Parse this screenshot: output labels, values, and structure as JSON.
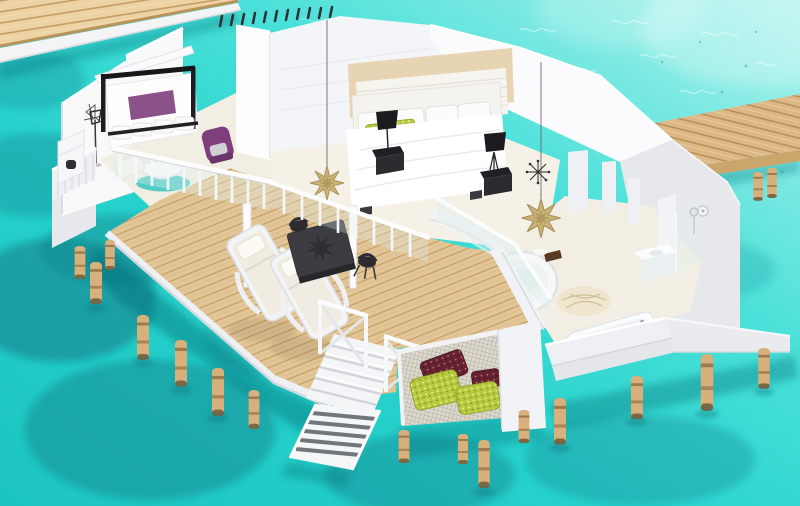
{
  "meta": {
    "title": "Overwater villa 3D cutaway render",
    "scene_type": "isometric architectural visualization",
    "visible_text": "none"
  },
  "colors": {
    "water_light": "#aff3ec",
    "water_bright": "#49e0d9",
    "water_mid": "#27d2cc",
    "water_deep": "#1cc5c0",
    "coral_dark": "#0d7a86",
    "coral_mid": "#129199",
    "wood_light": "#edd2a4",
    "wood_mid": "#ddb887",
    "wood_dark": "#c09a62",
    "wall_white": "#f9f9fa",
    "wall_shade": "#e7e8ec",
    "wall_dark": "#d2d4da",
    "floor_cream": "#f3eee3",
    "cushion_cream": "#f1ece1",
    "accent_purple": "#7e3f7c",
    "rug_teal": "#3ec9c1",
    "pillow_green": "#b9c93f",
    "pillow_maroon": "#66222e",
    "furniture_dark": "#2b2b30",
    "star_gold": "#c8b275",
    "glass_tint": "#dff0ee"
  },
  "scene": {
    "environment": {
      "setting": "turquoise lagoon with coral patches",
      "lighting": "bright daylight with sun glitter on water"
    },
    "structures": [
      {
        "name": "jetty-walkway",
        "material": "wood planks",
        "position": "top-left",
        "detail": "row of small dark bollards"
      },
      {
        "name": "access-boardwalk",
        "material": "wood planks",
        "position": "right edge"
      },
      {
        "name": "villa",
        "style": "white cutaway walls, open roof, on wooden stilts"
      }
    ],
    "rooms": [
      {
        "name": "lounge",
        "furniture": [
          "black-frame-canopy-daybed",
          "purple-armchair",
          "round-coffee-table",
          "teal-rug",
          "white-ottoman",
          "floor-lamp",
          "wall-art-sketch",
          "minibar-shelf",
          "side-balcony"
        ]
      },
      {
        "name": "bedroom",
        "furniture": [
          "double-bed-white",
          "slatted-headboard-panel",
          "beige-feature-wall",
          "black-nightstand-left",
          "black-nightstand-right",
          "black-table-lamp-left",
          "black-table-lamp-right",
          "green-accent-pillows",
          "gold-star-pendant"
        ]
      },
      {
        "name": "bathroom",
        "furniture": [
          "round-soaking-tub",
          "bathtub",
          "vanity",
          "glass-shower",
          "palm-leaf-rug",
          "gold-star-pendant",
          "black-sputnik-pendant",
          "exterior-light-fixture"
        ]
      }
    ],
    "deck": {
      "material": "diagonal wood planks",
      "furniture": [
        "sun-lounger-1",
        "sun-lounger-2",
        "dark-dining-table-with-star-motif",
        "dining-chair-1",
        "dining-chair-2",
        "white-support-pole-1",
        "white-support-pole-2",
        "white-railing-with-balusters",
        "glass-balustrade"
      ]
    },
    "water_features": [
      "net-hammock-with-patterned-pillows",
      "white-staircase-with-cross-railings",
      "striped-gangway-ladder-into-water",
      "wooden-stilt-piles"
    ]
  }
}
